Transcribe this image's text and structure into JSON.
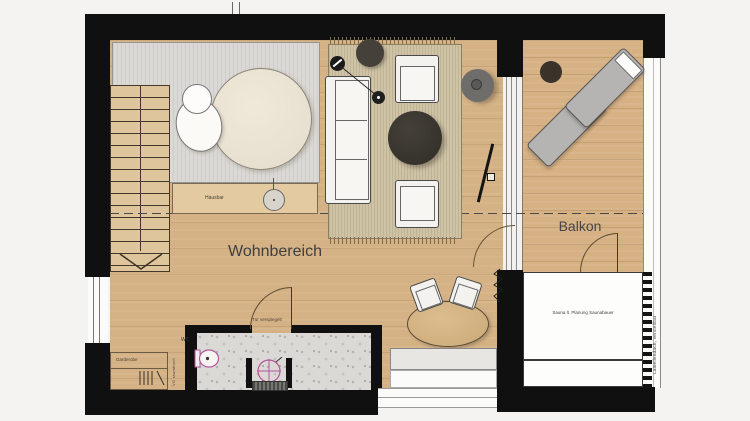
{
  "rooms": {
    "living": "Wohnbereich",
    "balcony": "Balkon"
  },
  "labels": {
    "hausbar": "Hausbar",
    "garderobe": "Garderobe",
    "wc": "WC",
    "mirror_door": "Tür verspiegelt",
    "sauna": "Sauna lt. Planung Saunabauer",
    "vg_wall": "VG raumhoch",
    "louver_roof": "Lamellendach, verstellbar"
  },
  "colors": {
    "wall": "#101010",
    "wood_floor": "#d5b285",
    "balcony_deck": "#d6b184",
    "carpet": "#dbd9d5",
    "rug": "#cfc3a6",
    "terrazzo": "#dad9d5",
    "sanitary_accent": "#b5569c",
    "dark_furniture": "#3a352e"
  }
}
